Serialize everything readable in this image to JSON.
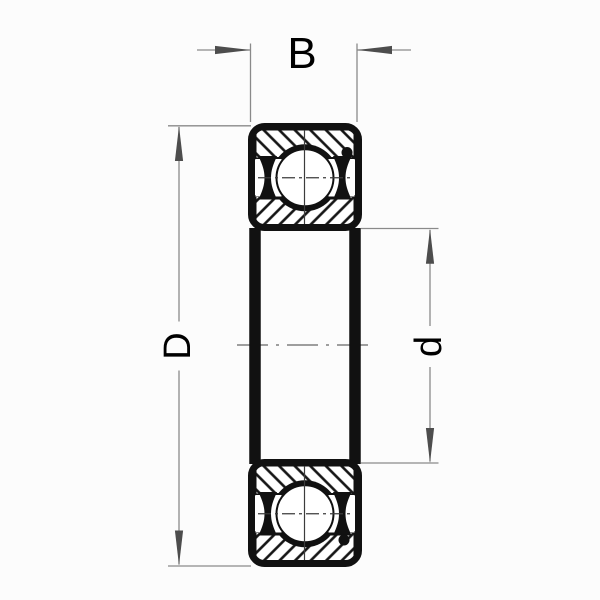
{
  "diagram": {
    "type": "bearing-cross-section-drawing",
    "labels": {
      "width": "B",
      "outer_diameter": "D",
      "bore_diameter": "d"
    },
    "colors": {
      "background": "#fcfcfc",
      "ink": "#111111",
      "dimension_lines": "#8a8a8a",
      "arrowheads": "#4d4d4d",
      "labels": "#000000"
    }
  }
}
